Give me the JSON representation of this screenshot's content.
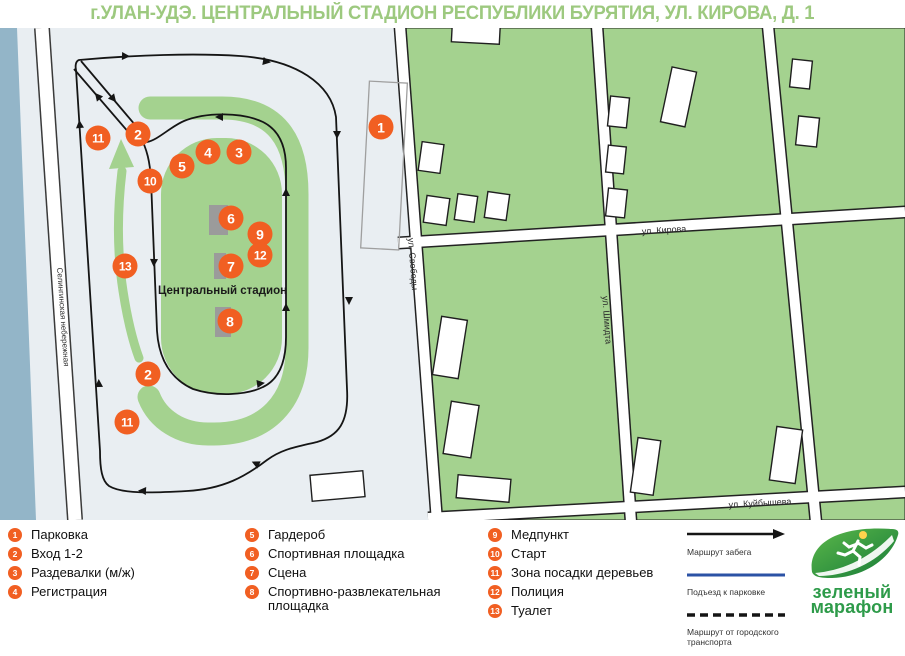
{
  "title": "г.УЛАН-УДЭ. ЦЕНТРАЛЬНЫЙ СТАДИОН РЕСПУБЛИКИ БУРЯТИЯ, УЛ. КИРОВА, Д. 1",
  "map": {
    "stadium_label": "Центральный стадион",
    "streets": [
      {
        "id": "kirova",
        "label": "ул. Кирова",
        "x": 664,
        "y": 230,
        "rot": -3.5,
        "small": false
      },
      {
        "id": "svobody",
        "label": "ул. Свободы",
        "x": 413,
        "y": 264,
        "rot": 85.7,
        "small": false
      },
      {
        "id": "shmidta",
        "label": "ул. Шмидта",
        "x": 607,
        "y": 320,
        "rot": 86,
        "small": false
      },
      {
        "id": "kuybysheva",
        "label": "ул. Куйбышева",
        "x": 760,
        "y": 503,
        "rot": -3.1,
        "small": false
      },
      {
        "id": "naberezhnaya",
        "label": "Селингинская небережная",
        "x": 63,
        "y": 317,
        "rot": 86,
        "small": true
      }
    ],
    "markers": [
      {
        "num": "1",
        "x": 381,
        "y": 127
      },
      {
        "num": "2",
        "x": 138,
        "y": 134
      },
      {
        "num": "3",
        "x": 239,
        "y": 152
      },
      {
        "num": "4",
        "x": 208,
        "y": 152
      },
      {
        "num": "5",
        "x": 182,
        "y": 166
      },
      {
        "num": "6",
        "x": 231,
        "y": 218
      },
      {
        "num": "7",
        "x": 231,
        "y": 266
      },
      {
        "num": "8",
        "x": 230,
        "y": 321
      },
      {
        "num": "9",
        "x": 260,
        "y": 234
      },
      {
        "num": "10",
        "x": 150,
        "y": 181
      },
      {
        "num": "11",
        "x": 98,
        "y": 138
      },
      {
        "num": "12",
        "x": 260,
        "y": 255
      },
      {
        "num": "13",
        "x": 125,
        "y": 266
      },
      {
        "num": "2",
        "x": 148,
        "y": 374
      },
      {
        "num": "11",
        "x": 127,
        "y": 422
      }
    ]
  },
  "legend": {
    "columns": [
      [
        {
          "num": "1",
          "label": "Парковка"
        },
        {
          "num": "2",
          "label": "Вход 1-2"
        },
        {
          "num": "3",
          "label": "Раздевалки (м/ж)"
        },
        {
          "num": "4",
          "label": "Регистрация"
        }
      ],
      [
        {
          "num": "5",
          "label": "Гардероб"
        },
        {
          "num": "6",
          "label": "Спортивная площадка"
        },
        {
          "num": "7",
          "label": "Сцена"
        },
        {
          "num": "8",
          "label": "Спортивно-развлекательная площадка"
        }
      ],
      [
        {
          "num": "9",
          "label": "Медпункт"
        },
        {
          "num": "10",
          "label": "Старт"
        },
        {
          "num": "11",
          "label": "Зона посадки деревьев"
        },
        {
          "num": "12",
          "label": "Полиция"
        },
        {
          "num": "13",
          "label": "Туалет"
        }
      ]
    ],
    "routes": [
      {
        "label": "Маршрут забега",
        "style": "solid-arrow"
      },
      {
        "label": "Подъезд к парковке",
        "style": "solid-blue"
      },
      {
        "label": "Маршрут от городского транспорта",
        "style": "dashed"
      }
    ]
  },
  "logo": {
    "line1": "зеленый",
    "line2": "марафон"
  },
  "colors": {
    "accent_orange": "#f15f22",
    "map_green": "#a4d28f",
    "map_bg": "#e9eef2",
    "river_blue": "#93b5c8",
    "route_black": "#151515",
    "route_blue": "#2b52a5",
    "logo_green": "#2e9b4a",
    "title_green": "#9dc97f"
  }
}
